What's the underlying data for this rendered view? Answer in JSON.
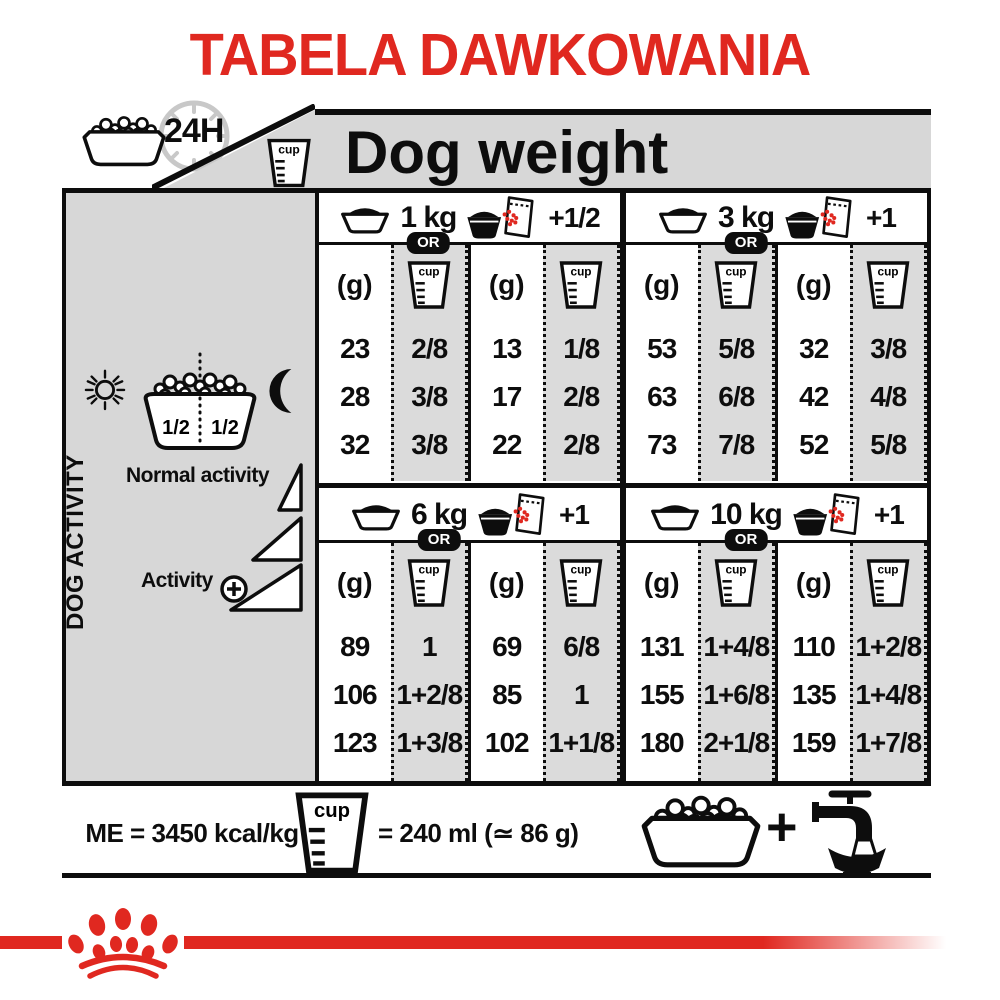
{
  "title": "TABELA DAWKOWANIA",
  "header": {
    "clock_label": "24H",
    "cup_label": "cup",
    "dog_weight_label": "Dog weight"
  },
  "sidebar": {
    "dog_activity_label": "DOG ACTIVITY",
    "normal_activity_label": "Normal activity",
    "activity_label": "Activity",
    "bowl_half_left": "1/2",
    "bowl_half_right": "1/2"
  },
  "sections": [
    {
      "weight": "1 kg",
      "or_label": "OR",
      "extra": "+1/2",
      "gram_header": "(g)",
      "dry": {
        "g": [
          "23",
          "28",
          "32"
        ],
        "cup": [
          "2/8",
          "3/8",
          "3/8"
        ]
      },
      "mixed": {
        "g": [
          "13",
          "17",
          "22"
        ],
        "cup": [
          "1/8",
          "2/8",
          "2/8"
        ]
      }
    },
    {
      "weight": "3 kg",
      "or_label": "OR",
      "extra": "+1",
      "gram_header": "(g)",
      "dry": {
        "g": [
          "53",
          "63",
          "73"
        ],
        "cup": [
          "5/8",
          "6/8",
          "7/8"
        ]
      },
      "mixed": {
        "g": [
          "32",
          "42",
          "52"
        ],
        "cup": [
          "3/8",
          "4/8",
          "5/8"
        ]
      }
    },
    {
      "weight": "6 kg",
      "or_label": "OR",
      "extra": "+1",
      "gram_header": "(g)",
      "dry": {
        "g": [
          "89",
          "106",
          "123"
        ],
        "cup": [
          "1",
          "1+2/8",
          "1+3/8"
        ]
      },
      "mixed": {
        "g": [
          "69",
          "85",
          "102"
        ],
        "cup": [
          "6/8",
          "1",
          "1+1/8"
        ]
      }
    },
    {
      "weight": "10 kg",
      "or_label": "OR",
      "extra": "+1",
      "gram_header": "(g)",
      "dry": {
        "g": [
          "131",
          "155",
          "180"
        ],
        "cup": [
          "1+4/8",
          "1+6/8",
          "2+1/8"
        ]
      },
      "mixed": {
        "g": [
          "110",
          "135",
          "159"
        ],
        "cup": [
          "1+2/8",
          "1+4/8",
          "1+7/8"
        ]
      }
    }
  ],
  "footer": {
    "me_label": "ME = 3450 kcal/kg",
    "cup_label": "cup",
    "cup_equivalence": "= 240 ml (≃ 86 g)",
    "plus_sign": "+"
  },
  "colors": {
    "brand_red": "#e02820",
    "panel_gray": "#d7d7d7",
    "cup_column_gray": "#dbdbdb",
    "clock_gray": "#c8c8c8"
  }
}
